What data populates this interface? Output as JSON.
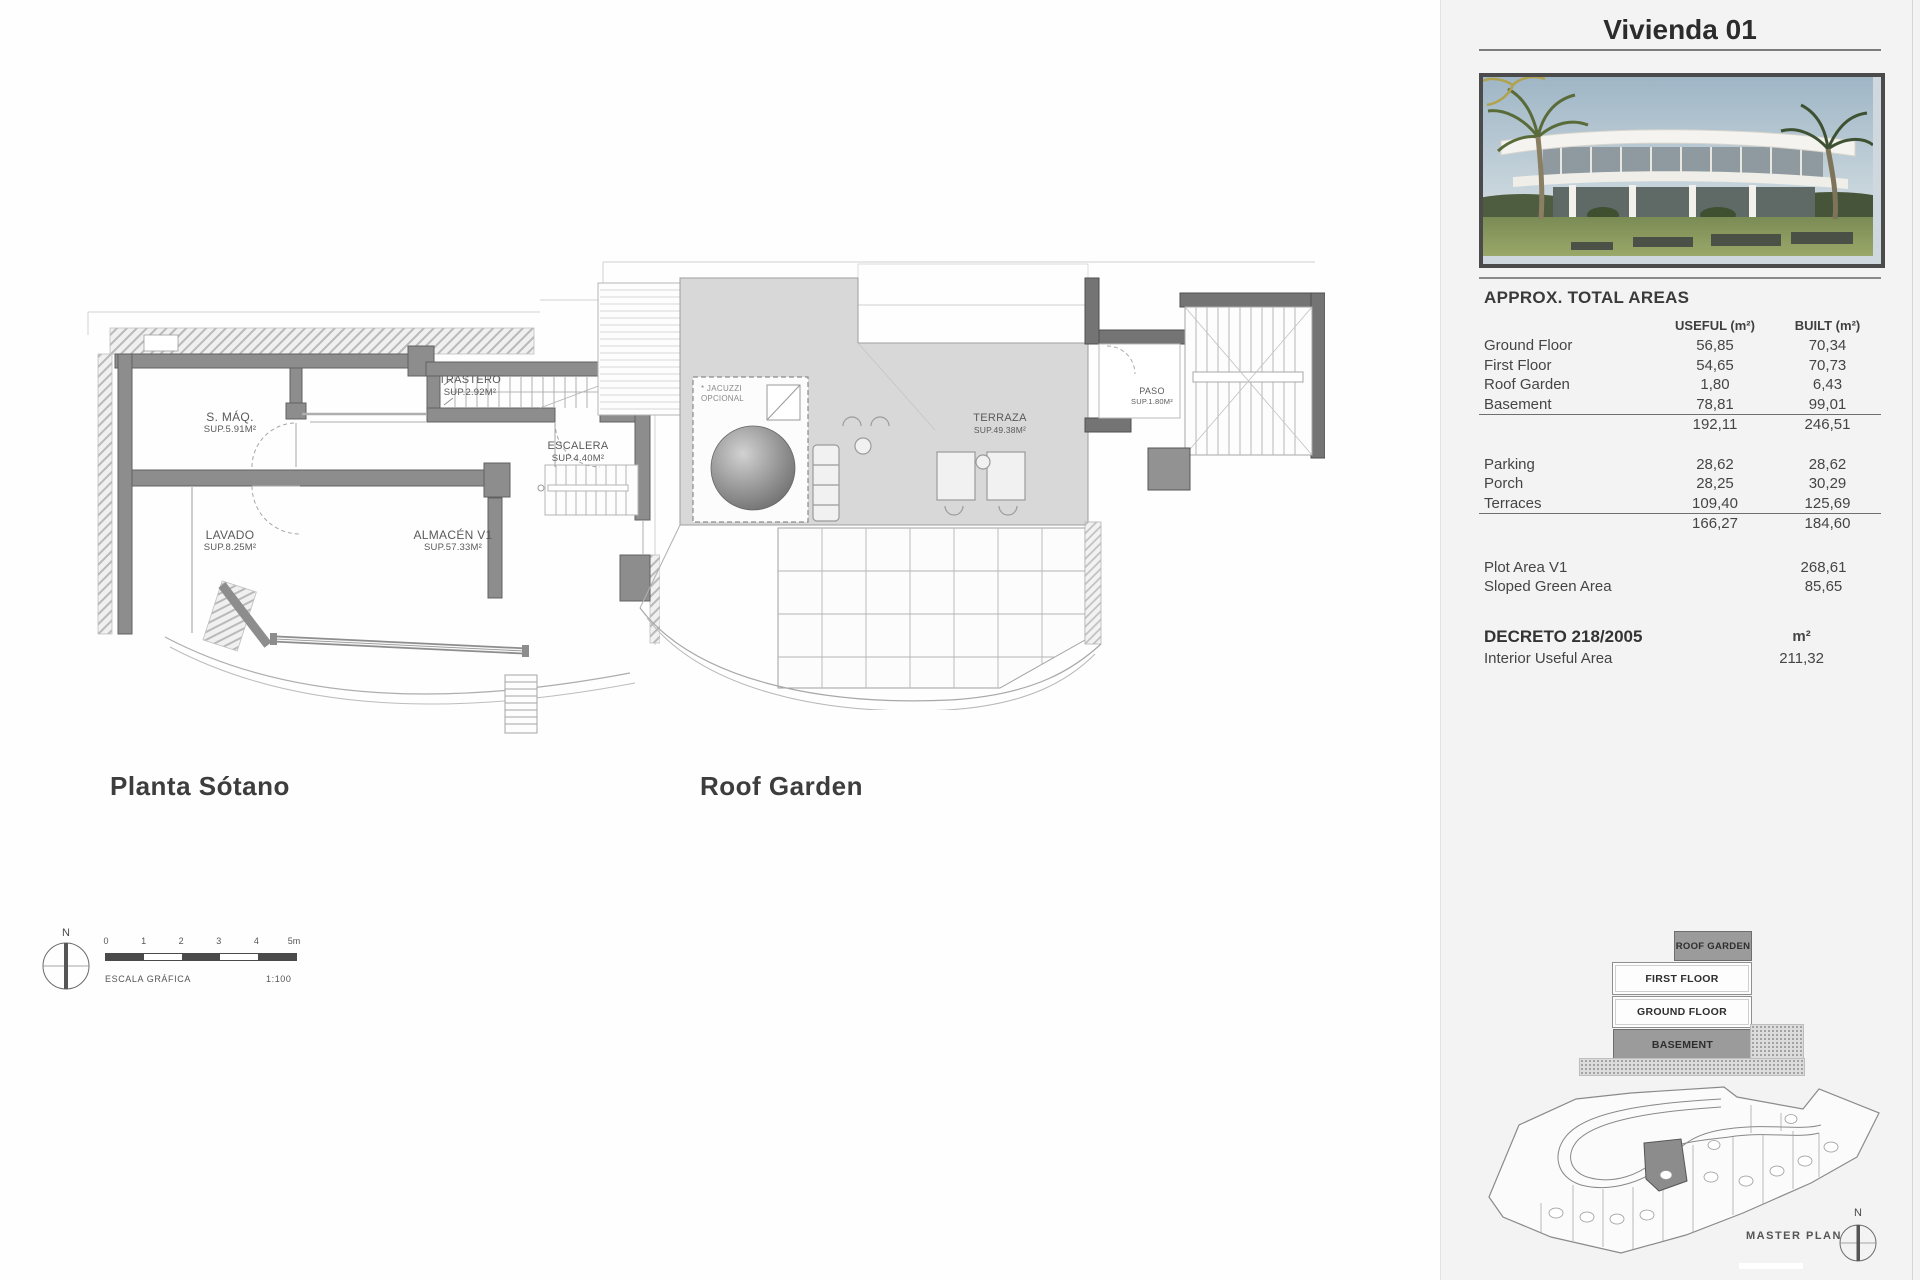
{
  "plans": {
    "basement": {
      "title": "Planta Sótano",
      "rooms": {
        "smaq": {
          "name": "S. MÁQ.",
          "area": "SUP.5.91M²"
        },
        "lavado": {
          "name": "LAVADO",
          "area": "SUP.8.25M²"
        },
        "trastero": {
          "name": "TRASTERO",
          "area": "SUP.2.92M²"
        },
        "escalera": {
          "name": "ESCALERA",
          "area": "SUP.4.40M²"
        },
        "almacen": {
          "name": "ALMACÉN V1",
          "area": "SUP.57.33M²"
        }
      }
    },
    "roof": {
      "title": "Roof Garden",
      "rooms": {
        "terraza": {
          "name": "TERRAZA",
          "area": "SUP.49.38M²"
        },
        "paso": {
          "name": "PASO",
          "area": "SUP.1.80M²"
        },
        "jacuzzi": {
          "name": "* JACUZZI",
          "area": "OPCIONAL"
        }
      }
    }
  },
  "scale": {
    "ticks": [
      "0",
      "1",
      "2",
      "3",
      "4",
      "5m"
    ],
    "caption": "ESCALA GRÁFICA",
    "ratio": "1:100",
    "north": "N"
  },
  "sidebar": {
    "title": "Vivienda 01",
    "areas": {
      "heading": "APPROX. TOTAL AREAS",
      "columns": {
        "useful": "USEFUL (m²)",
        "built": "BUILT (m²)"
      },
      "floors": [
        {
          "label": "Ground Floor",
          "useful": "56,85",
          "built": "70,34"
        },
        {
          "label": "First Floor",
          "useful": "54,65",
          "built": "70,73"
        },
        {
          "label": "Roof Garden",
          "useful": "1,80",
          "built": "6,43"
        },
        {
          "label": "Basement",
          "useful": "78,81",
          "built": "99,01"
        }
      ],
      "floors_total": {
        "useful": "192,11",
        "built": "246,51"
      },
      "exterior": [
        {
          "label": "Parking",
          "useful": "28,62",
          "built": "28,62"
        },
        {
          "label": "Porch",
          "useful": "28,25",
          "built": "30,29"
        },
        {
          "label": "Terraces",
          "useful": "109,40",
          "built": "125,69"
        }
      ],
      "exterior_total": {
        "useful": "166,27",
        "built": "184,60"
      },
      "plot": [
        {
          "label": "Plot Area V1",
          "value": "268,61"
        },
        {
          "label": "Sloped Green Area",
          "value": "85,65"
        }
      ],
      "decreto": {
        "heading": "DECRETO 218/2005",
        "unit": "m²",
        "label": "Interior Useful Area",
        "value": "211,32"
      }
    },
    "stack": {
      "roof": "ROOF GARDEN",
      "first": "FIRST FLOOR",
      "ground": "GROUND FLOOR",
      "basement": "BASEMENT"
    },
    "master_plan": {
      "label": "MASTER PLAN",
      "north": "N"
    }
  }
}
